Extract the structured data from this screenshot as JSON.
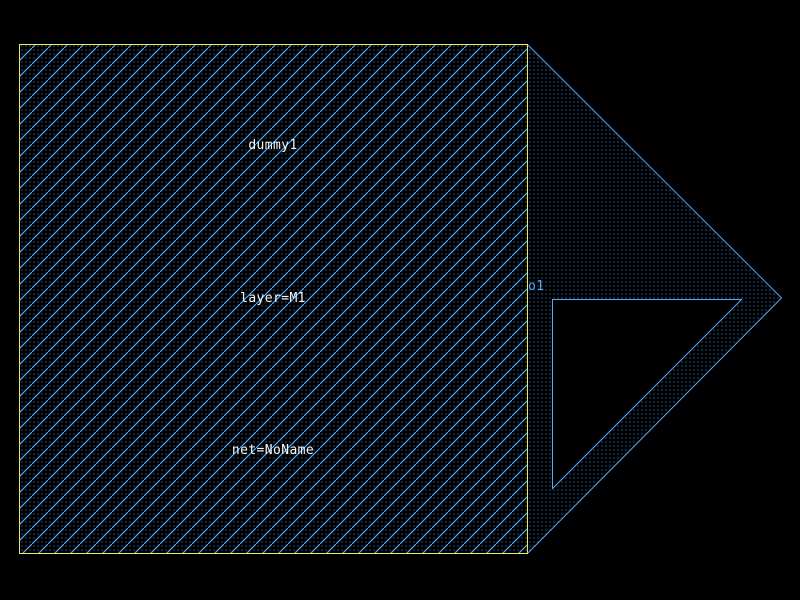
{
  "colors": {
    "background": "#000000",
    "pattern_blue": "#55a8f8",
    "dot_blue": "#4499ee",
    "cell_border_yellow": "#ebeb55",
    "label_white": "#f8f8f8",
    "port_blue": "#55a8f8",
    "notch_black": "#000000"
  },
  "cell": {
    "name": "dummy1",
    "layer": "layer=M1",
    "net": "net=NoName"
  },
  "port": {
    "name": "o1"
  }
}
